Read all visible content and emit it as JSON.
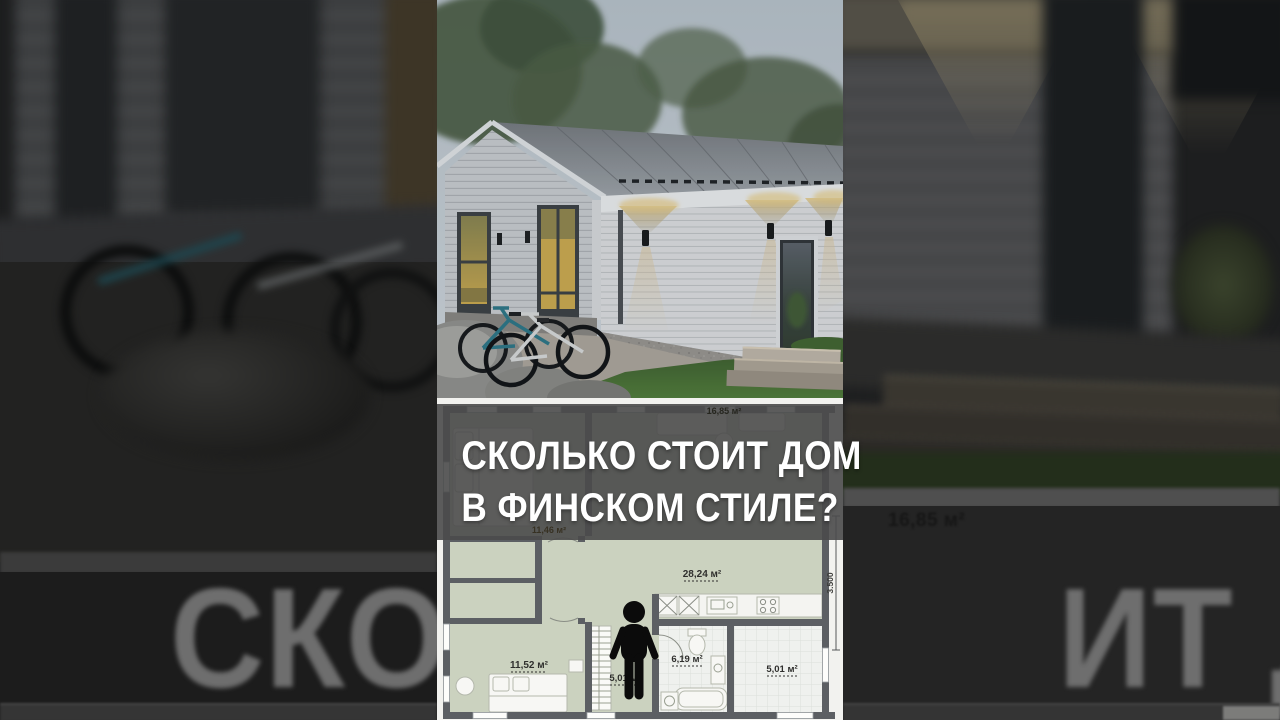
{
  "overlay": {
    "title_line1": "СКОЛЬКО СТОИТ ДОМ",
    "title_line2": "В ФИНСКОМ СТИЛЕ?"
  },
  "floor_plan": {
    "top_area_label": "16,85 м²",
    "dimension_label": "3.500",
    "rooms": [
      {
        "id": "bedroom-top",
        "area_label": "11,46 м²"
      },
      {
        "id": "living-kitchen",
        "area_label": "28,24 м²"
      },
      {
        "id": "bedroom-bottom",
        "area_label": "11,52 м²"
      },
      {
        "id": "hallway",
        "area_label": "5,01 м²"
      },
      {
        "id": "bathroom",
        "area_label": "6,19 м²"
      },
      {
        "id": "storage-right",
        "area_label": "5,01 м²"
      }
    ]
  },
  "background": {
    "big_text_left": "СКОЛЬ",
    "big_text_right": "ИТ ДОМ",
    "area_label": "16,85 м²"
  },
  "colors": {
    "overlay_text": "#ffffff",
    "overlay_fill": "#4a4a4a",
    "plan_room_green": "#cbd2bf",
    "plan_wall": "#5c5f63",
    "warm_light": "#d9c183",
    "background_text": "#6e6e6e"
  }
}
